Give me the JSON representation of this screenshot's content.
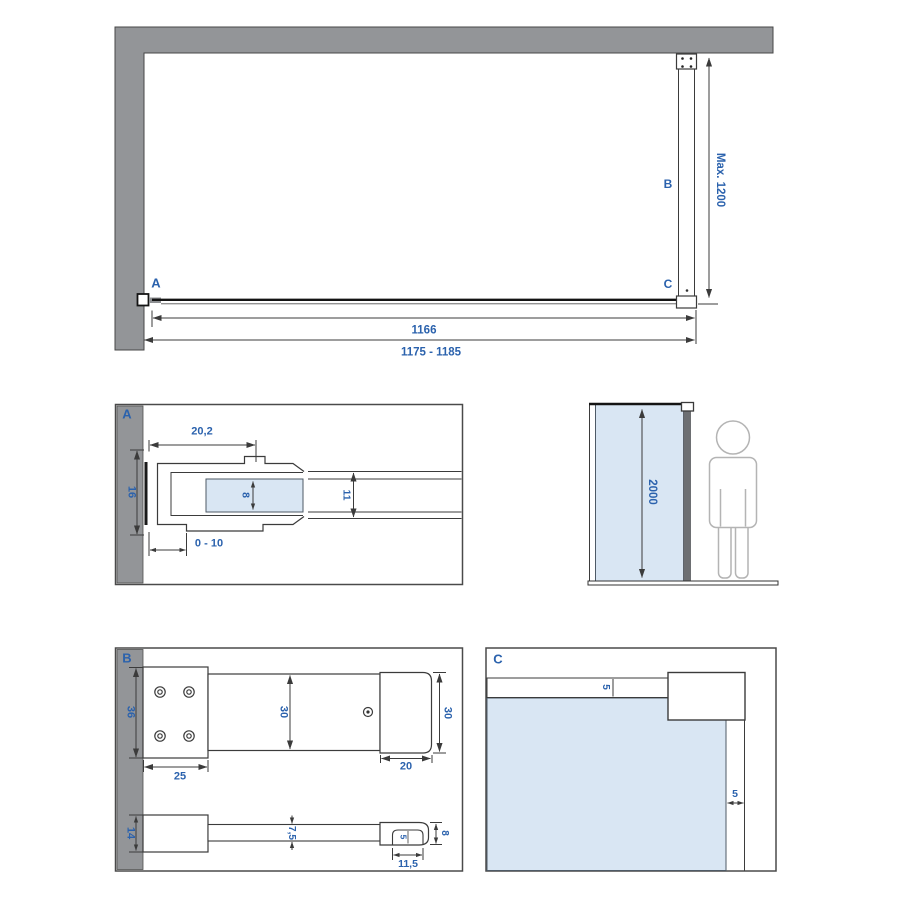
{
  "drawing_type": "shower walk-in glass panel installation diagram",
  "colors": {
    "wall_gray": "#939598",
    "glass_blue": "#d9e6f3",
    "dimension_text_blue": "#2b62ad",
    "line_color": "#3b3b3b"
  },
  "plan_view": {
    "point_labels": {
      "a": "A",
      "b": "B",
      "c": "C"
    },
    "dims": {
      "bar_max_length": "Max. 1200",
      "glass_width": "1166",
      "total_width": "1175 - 1185"
    }
  },
  "detail_a": {
    "label": "A",
    "dims": {
      "profile_depth": "20,2",
      "profile_height": "16",
      "glass_thickness": "8",
      "profile_outer": "11",
      "adjustment": "0 - 10"
    }
  },
  "elevation": {
    "dims": {
      "panel_height": "2000"
    }
  },
  "detail_b": {
    "label": "B",
    "dims": {
      "plate_height": "36",
      "plate_width": "25",
      "bar_width": "30",
      "cap_height": "30",
      "cap_width": "20",
      "block_height": "14",
      "bar_thickness": "7,5",
      "notch_depth": "5",
      "end_thickness": "8",
      "notch_width": "11,5"
    }
  },
  "detail_c": {
    "label": "C",
    "dims": {
      "top_gap": "5",
      "side_gap": "5"
    }
  }
}
